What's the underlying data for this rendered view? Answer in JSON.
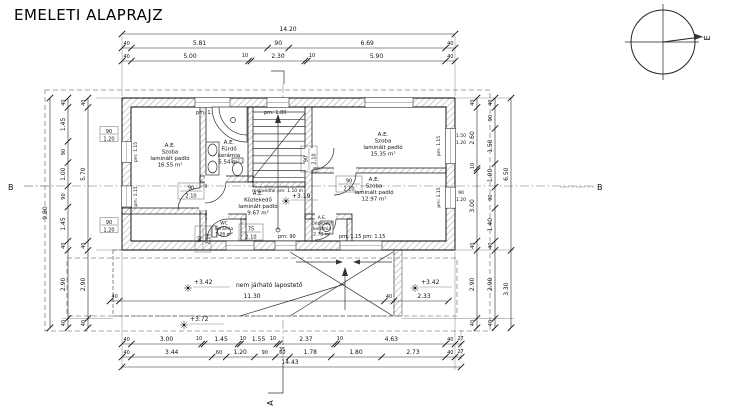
{
  "title": "EMELETI ALAPRAJZ",
  "compass": {
    "north": "É"
  },
  "sections": {
    "a": "A",
    "b_left": "B",
    "b_right": "B"
  },
  "dims": {
    "top1": [
      "14.20"
    ],
    "top2": [
      "40",
      "5.81",
      "90",
      "6.69",
      "40"
    ],
    "top3": [
      "40",
      "5.00",
      "10",
      "2.30",
      "10",
      "5.90",
      "40"
    ],
    "bottom1": [
      "40",
      "3.00",
      "10",
      "1.45",
      "10",
      "1.55",
      "10",
      "35",
      "2.37",
      "10",
      "4.63",
      "40",
      "27"
    ],
    "bottom2": [
      "40",
      "3.44",
      "60",
      "1.20",
      "90",
      "60",
      "1.78",
      "1.80",
      "2.73",
      "40",
      "27"
    ],
    "bottom3": [
      "14.43"
    ],
    "left1": [
      "9.80"
    ],
    "left2": [
      "40",
      "1.45",
      "90",
      "1.00",
      "90",
      "1.45",
      "40",
      "2.90",
      "40"
    ],
    "left3": [
      "40",
      "5.70",
      "40",
      "2.90",
      "40"
    ],
    "rightA": [
      "40",
      "2.60",
      "10",
      "3.00",
      "40",
      "2.90",
      "40"
    ],
    "rightB": [
      "40",
      "90",
      "1.50",
      "1.00",
      "90",
      "1.40",
      "40",
      "2.90",
      "40"
    ],
    "rightC": [
      "6.50",
      "3.30"
    ],
    "roof": [
      "40",
      "11.30",
      "40",
      "2.33"
    ]
  },
  "rooms": {
    "szoba1": {
      "tag": "A.E.",
      "name": "Szoba",
      "floor": "laminált padló",
      "area": "16.55 m²"
    },
    "furdo": {
      "tag": "A.E.",
      "name": "Fürdő",
      "floor": "kerámia",
      "area": "5.54 m²"
    },
    "szoba2": {
      "tag": "A.E.",
      "name": "Szoba",
      "floor": "laminált padló",
      "area": "15.35 m²"
    },
    "szoba3": {
      "tag": "A.E.",
      "name": "Szoba",
      "floor": "laminált padló",
      "area": "12.97 m²"
    },
    "kozlekedo": {
      "tag": "A.E.",
      "name": "Közlekedő",
      "floor": "laminált padló",
      "area": "9.67 m²"
    },
    "wc": {
      "name": "WC",
      "floor": "kerámia",
      "area": "1.26 m²"
    },
    "gepeszet": {
      "tag": "A.E.",
      "name": "Gépészet",
      "floor": "kerámia",
      "area": "2.73 m²"
    }
  },
  "levels": {
    "corridor": "+3.19",
    "roof_left": "+3.42",
    "roof_right": "+3.42",
    "roof_front": "+3.72"
  },
  "roof": {
    "label": "nem járható lapostető"
  },
  "stairs": {
    "parapet": "mellvédfal pm: 1.10 m"
  },
  "doors": {
    "szoba1": {
      "w": "90",
      "h": "2.10"
    },
    "furdo": {
      "w": "90",
      "h": "2.10"
    },
    "szoba2": {
      "w": "90",
      "h": "2.10"
    },
    "szoba3": {
      "w": "90",
      "h": "2.10"
    },
    "wc": {
      "w": "75",
      "h": "2.10"
    }
  },
  "windows": {
    "top1": {
      "pm": "pm: 1.80"
    },
    "top2": {
      "pm": "pm: 1.80"
    },
    "left1": {
      "w": "90",
      "h": "1.20",
      "pm": "pm: 1.15"
    },
    "left2": {
      "w": "90",
      "h": "1.20",
      "pm": "pm: 1.15"
    },
    "right1": {
      "w": "1.50",
      "h": "1.20",
      "pm": "pm: 1.15"
    },
    "right2": {
      "w": "90",
      "h": "1.20",
      "pm": "pm: 1.15"
    },
    "bottom1": {
      "pm": "pm: 90"
    },
    "bottom2": {
      "pm": "pm: 1.15 pm: 1.15"
    }
  }
}
